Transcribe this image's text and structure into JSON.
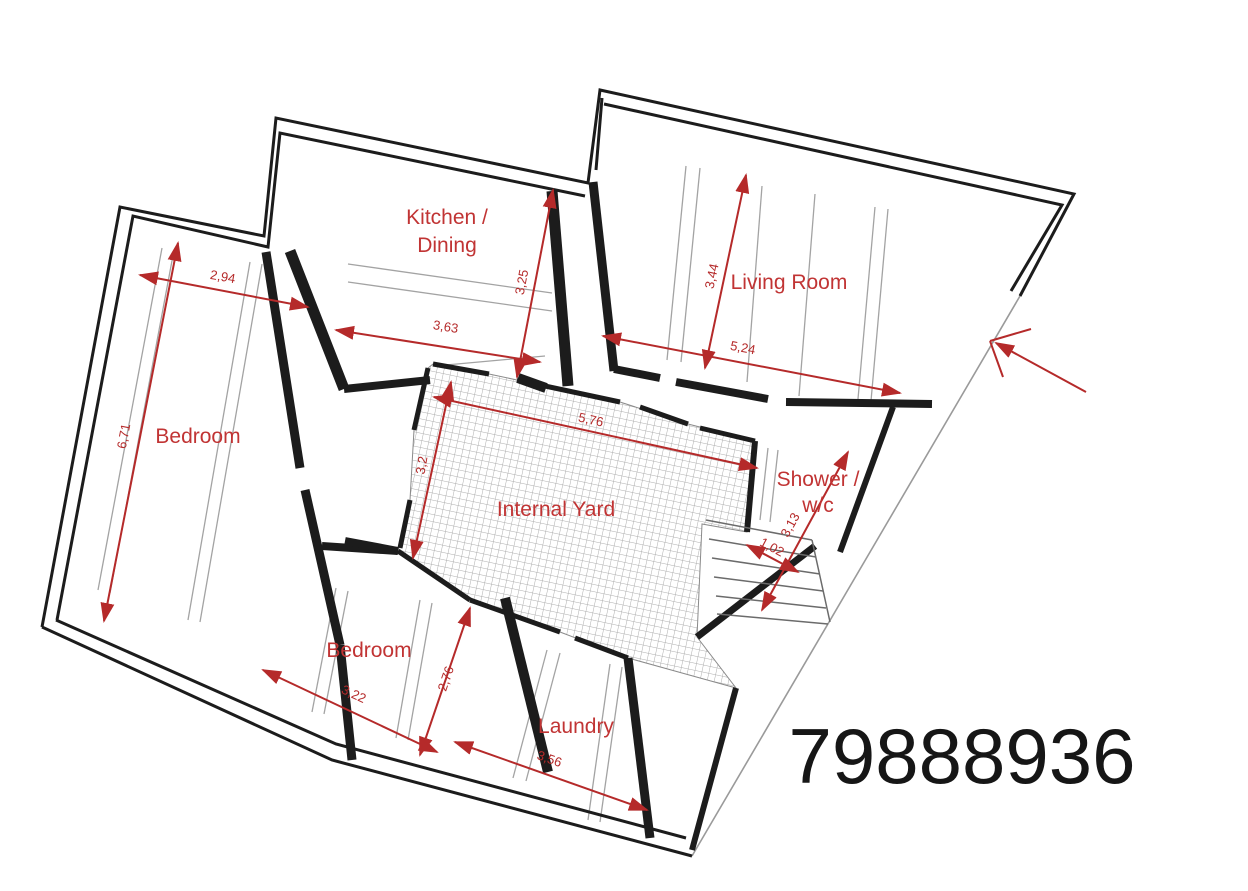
{
  "listing_number": "79888936",
  "colors": {
    "wall": "#1c1c1c",
    "dimension_red": "#b52a2a",
    "label_red": "#c13434",
    "guide_gray": "#a3a3a3",
    "boundary_gray": "#9a9a9a",
    "yard_hatch": "#adadad"
  },
  "rooms": {
    "kitchen_dining": {
      "line1": "Kitchen /",
      "line2": "Dining"
    },
    "living_room": {
      "label": "Living Room"
    },
    "bedroom_left": {
      "label": "Bedroom"
    },
    "internal_yard": {
      "label": "Internal Yard"
    },
    "shower_wc": {
      "line1": "Shower /",
      "line2": "w/c"
    },
    "bedroom_lower": {
      "label": "Bedroom"
    },
    "laundry": {
      "label": "Laundry"
    }
  },
  "dimensions_m": {
    "bedroom_left_width": "2,94",
    "bedroom_left_length": "6,71",
    "hall_width": "3,63",
    "kitchen_depth": "3,25",
    "living_room_depth": "3,44",
    "living_room_width": "5,24",
    "yard_width": "5,76",
    "yard_depth": "3,2",
    "stair_run": "3,13",
    "stair_width": "1,02",
    "bedroom_lower_width": "3,22",
    "bedroom_lower_depth": "2,76",
    "laundry_width": "3,56"
  }
}
